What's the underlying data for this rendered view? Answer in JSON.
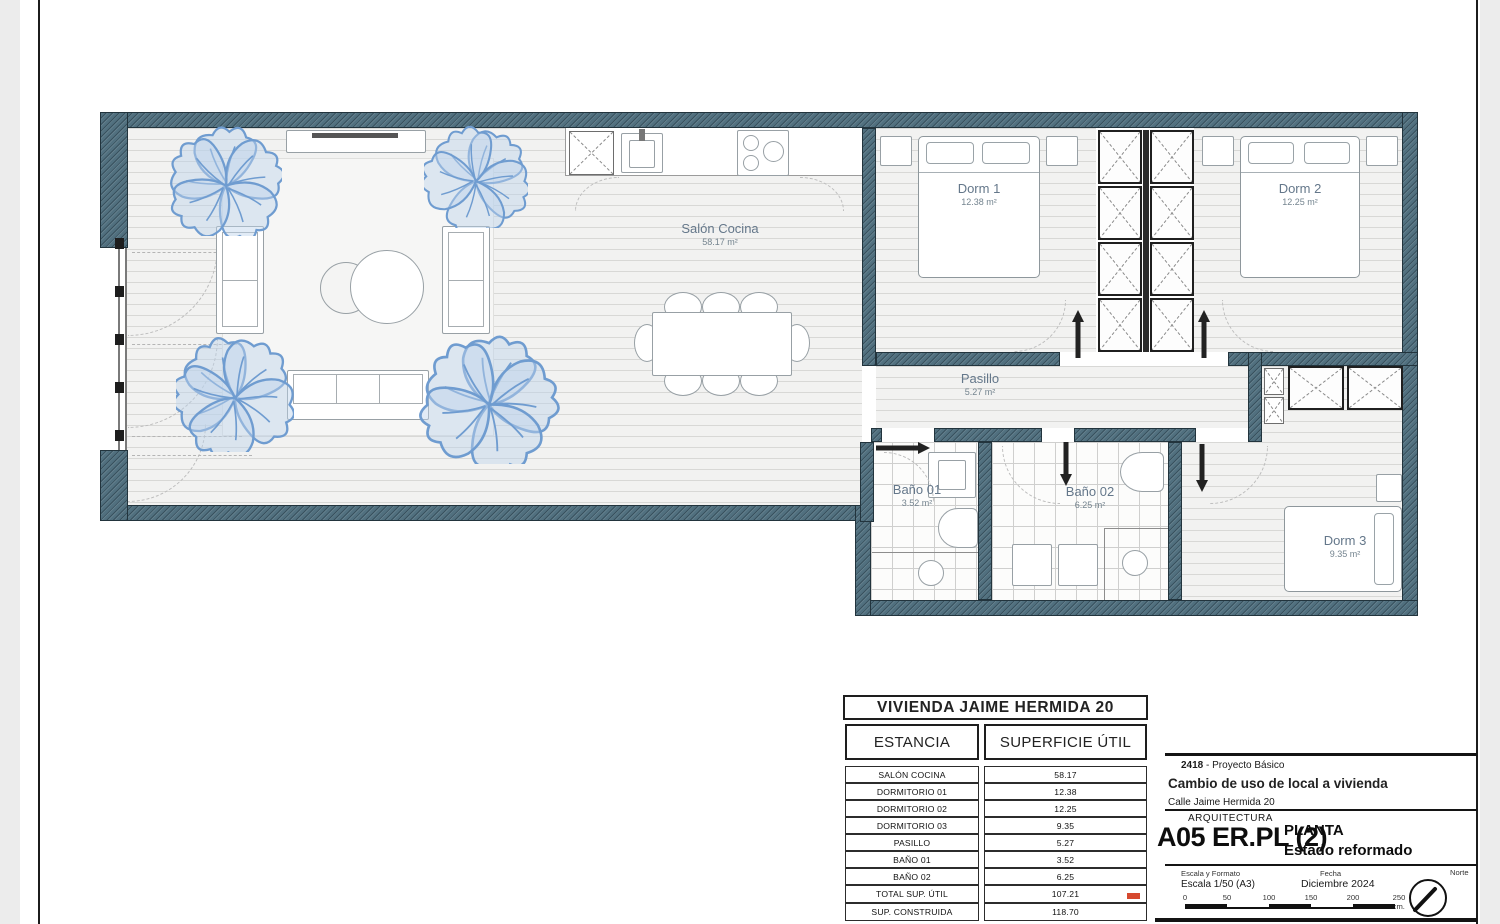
{
  "plan": {
    "rooms": {
      "salon": {
        "name": "Salón Cocina",
        "area": "58.17 m²"
      },
      "dorm1": {
        "name": "Dorm 1",
        "area": "12.38 m²"
      },
      "dorm2": {
        "name": "Dorm 2",
        "area": "12.25 m²"
      },
      "dorm3": {
        "name": "Dorm 3",
        "area": "9.35 m²"
      },
      "pasillo": {
        "name": "Pasillo",
        "area": "5.27 m²"
      },
      "bano1": {
        "name": "Baño 01",
        "area": "3.52 m²"
      },
      "bano2": {
        "name": "Baño 02",
        "area": "6.25 m²"
      }
    },
    "colors": {
      "wall": "#51707f",
      "plant": "#6f9cd0",
      "floor_line": "#d8d8d6"
    }
  },
  "table": {
    "title": "VIVIENDA JAIME HERMIDA 20",
    "col1": "ESTANCIA",
    "col2": "SUPERFICIE ÚTIL",
    "rows": [
      {
        "label": "SALÓN COCINA",
        "value": "58.17"
      },
      {
        "label": "DORMITORIO 01",
        "value": "12.38"
      },
      {
        "label": "DORMITORIO 02",
        "value": "12.25"
      },
      {
        "label": "DORMITORIO 03",
        "value": "9.35"
      },
      {
        "label": "PASILLO",
        "value": "5.27"
      },
      {
        "label": "BAÑO 01",
        "value": "3.52"
      },
      {
        "label": "BAÑO 02",
        "value": "6.25"
      },
      {
        "label": "TOTAL SUP. ÚTIL",
        "value": "107.21"
      },
      {
        "label": "SUP. CONSTRUIDA",
        "value": "118.70"
      }
    ]
  },
  "titleblock": {
    "project_number": "2418",
    "project_number_rest": " - Proyecto Básico",
    "project_title": "Cambio de uso de local a vivienda",
    "address": "Calle Jaime Hermida 20",
    "discipline": "ARQUITECTURA",
    "sheet_code": "A05 ER.PL (2)",
    "sheet_name_line1": "PLANTA",
    "sheet_name_line2": "Estado reformado",
    "scale_label": "Escala y Formato",
    "scale_value": "Escala 1/50 (A3)",
    "date_label": "Fecha",
    "date_value": "Diciembre 2024",
    "north_label": "Norte",
    "scalebar": [
      "0",
      "50",
      "100",
      "150",
      "200",
      "250 cm."
    ]
  }
}
